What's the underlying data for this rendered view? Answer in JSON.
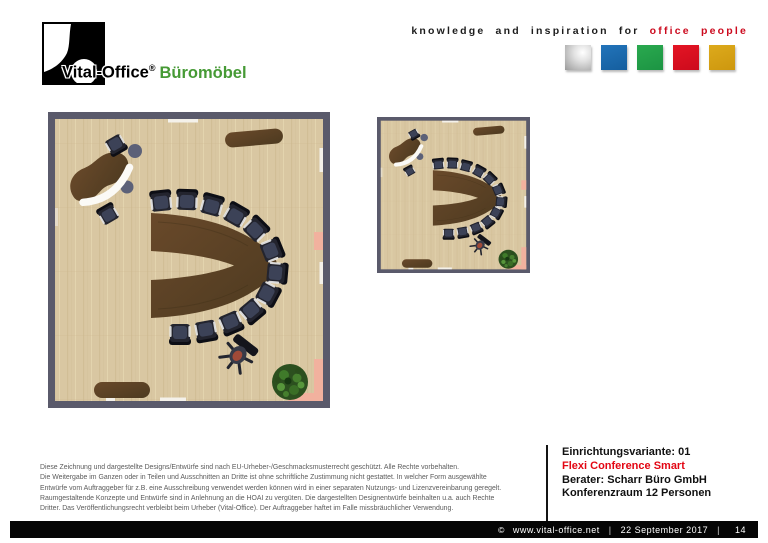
{
  "header": {
    "logo": {
      "name": "Vital-Office",
      "registered": "®",
      "product": "Büromöbel",
      "product_color": "#469a35"
    },
    "tagline": {
      "black": "knowledge and inspiration for",
      "red": "office people",
      "red_color": "#cc0a1e"
    },
    "color_squares": [
      {
        "name": "silver",
        "color": "#c0c0c0"
      },
      {
        "name": "blue",
        "color": "#1a68ad"
      },
      {
        "name": "green",
        "color": "#21a04b"
      },
      {
        "name": "red",
        "color": "#df0d20"
      },
      {
        "name": "gold",
        "color": "#d8a214"
      }
    ]
  },
  "floorplan_colors": {
    "wall": "#5a5a6b",
    "floor": "#d9c7a2",
    "furniture_wood": "#5d4226",
    "chairs": "#23242e",
    "plant": "#2c501f",
    "door_mat": "#f2b19e"
  },
  "disclaimer": {
    "lines": [
      "Diese Zeichnung und dargestellte Designs/Entwürfe sind nach EU-Urheber-/Geschmacksmusterrecht geschützt. Alle Rechte vorbehalten.",
      "Die Weitergabe im Ganzen oder in Teilen und Ausschnitten an Dritte ist ohne schriftliche Zustimmung nicht gestattet. In welcher Form ausgewählte",
      "Entwürfe vom Auftraggeber für z.B. eine Ausschreibung verwendet werden können wird in einer separaten Nutzungs- und Lizenzvereinbarung geregelt.",
      "Raumgestaltende Konzepte und Entwürfe sind in Anlehnung an die HOAI zu vergüten. Die dargestellten Designentwürfe beinhalten u.a. auch Rechte",
      "Dritter. Das Veröffentlichungsrecht verbleibt beim Urheber (Vital-Office). Der Auftraggeber haftet im Falle missbräuchlicher Verwendung."
    ]
  },
  "project": {
    "variant": "Einrichtungsvariante: 01",
    "product_name": "Flexi Conference Smart",
    "product_name_color": "#e30613",
    "consultant": "Berater: Scharr Büro GmbH",
    "room": "Konferenzraum 12 Personen"
  },
  "footer": {
    "copyright": "©",
    "website": "www.vital-office.net",
    "separator": "|",
    "date": "22 September 2017",
    "page": "14"
  }
}
